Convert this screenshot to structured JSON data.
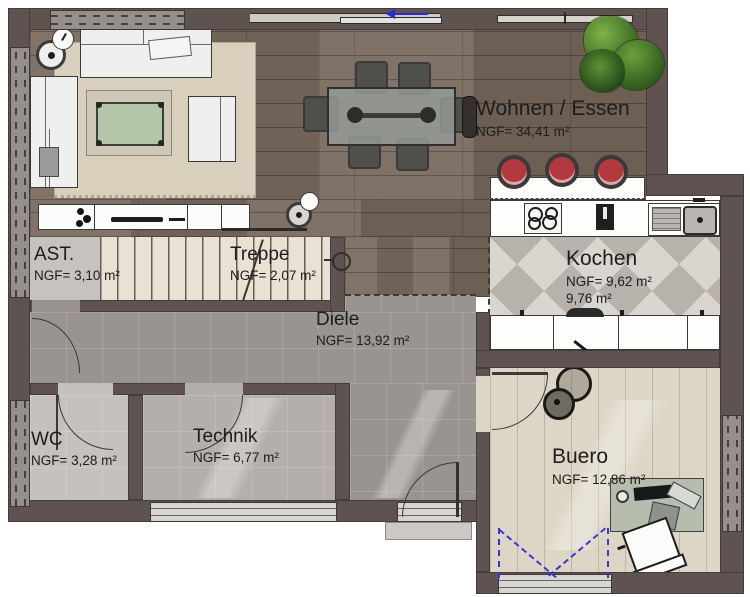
{
  "plan": {
    "type": "floorplan",
    "rooms": [
      {
        "id": "wohnen-essen",
        "label": "Wohnen / Essen",
        "area": "NGF= 34,41 m²"
      },
      {
        "id": "ast",
        "label": "AST.",
        "area": "NGF= 3,10 m²"
      },
      {
        "id": "treppe",
        "label": "Treppe",
        "area": "NGF= 2,07 m²"
      },
      {
        "id": "kochen",
        "label": "Kochen",
        "area": "NGF= 9,62 m²",
        "area2": "9,76 m²"
      },
      {
        "id": "diele",
        "label": "Diele",
        "area": "NGF= 13,92 m²"
      },
      {
        "id": "wc",
        "label": "WC",
        "area": "NGF= 3,28 m²"
      },
      {
        "id": "technik",
        "label": "Technik",
        "area": "NGF= 6,77 m²"
      },
      {
        "id": "buero",
        "label": "Buero",
        "area": "NGF= 12,86 m²"
      }
    ],
    "colors": {
      "wall": "#5e5350",
      "wood_floor": "#796a5e",
      "tile_diele": "#9a9490",
      "tile_wc": "#c5c2be",
      "tile_technik": "#b3afab",
      "stairs_floor": "#e9e1d3",
      "kitchen_tile_light": "#d9d6cf",
      "kitchen_tile_dark": "#b7b3ac",
      "office_floor": "#ddd5c5",
      "stool_red": "#b23a3e",
      "plant_green": "#4f7d2c",
      "door_swing_blue": "#3b35d6"
    }
  }
}
